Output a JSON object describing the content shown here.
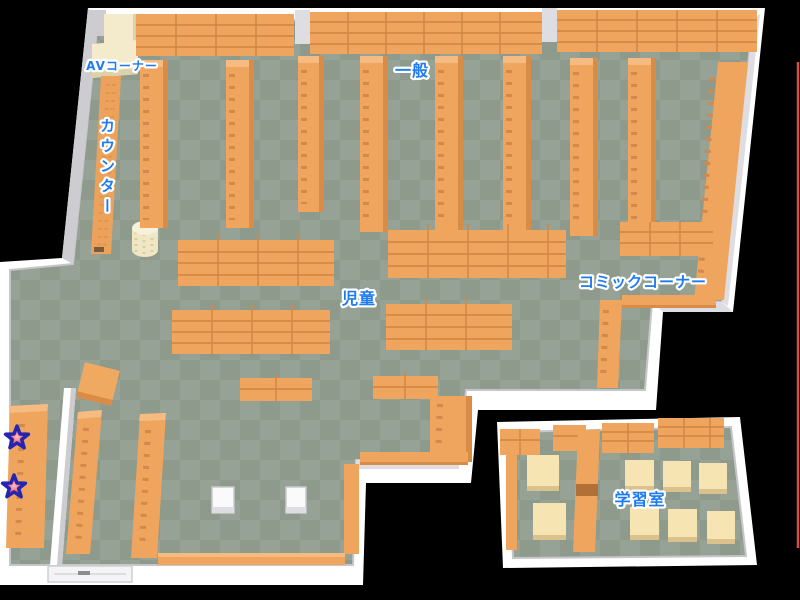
{
  "map": {
    "areas": [
      {
        "id": "av-corner",
        "label": "AVコーナー"
      },
      {
        "id": "general",
        "label": "一般"
      },
      {
        "id": "counter",
        "label": "カウンター"
      },
      {
        "id": "children",
        "label": "児童"
      },
      {
        "id": "comic-corner",
        "label": "コミックコーナー"
      },
      {
        "id": "study-room",
        "label": "学習室"
      }
    ],
    "markers": [
      {
        "id": "star-1",
        "x": 17,
        "y": 438
      },
      {
        "id": "star-2",
        "x": 14,
        "y": 487
      }
    ],
    "colors": {
      "floor_dark": "#8e9b8c",
      "floor_light": "#96a295",
      "shelf": "#f0a55e",
      "shelf_dark": "#d88c48",
      "shelf_cap": "#f6bb80",
      "wall": "#ffffff",
      "wall_shade": "#cdcdd1",
      "av_shelf": "#f4ebcd",
      "table": "#f6e5b3",
      "label_text": "#1e7cf0",
      "star_fill": "#f25763",
      "star_outline": "#2525b2",
      "boundary_line": "#cc5252"
    }
  }
}
